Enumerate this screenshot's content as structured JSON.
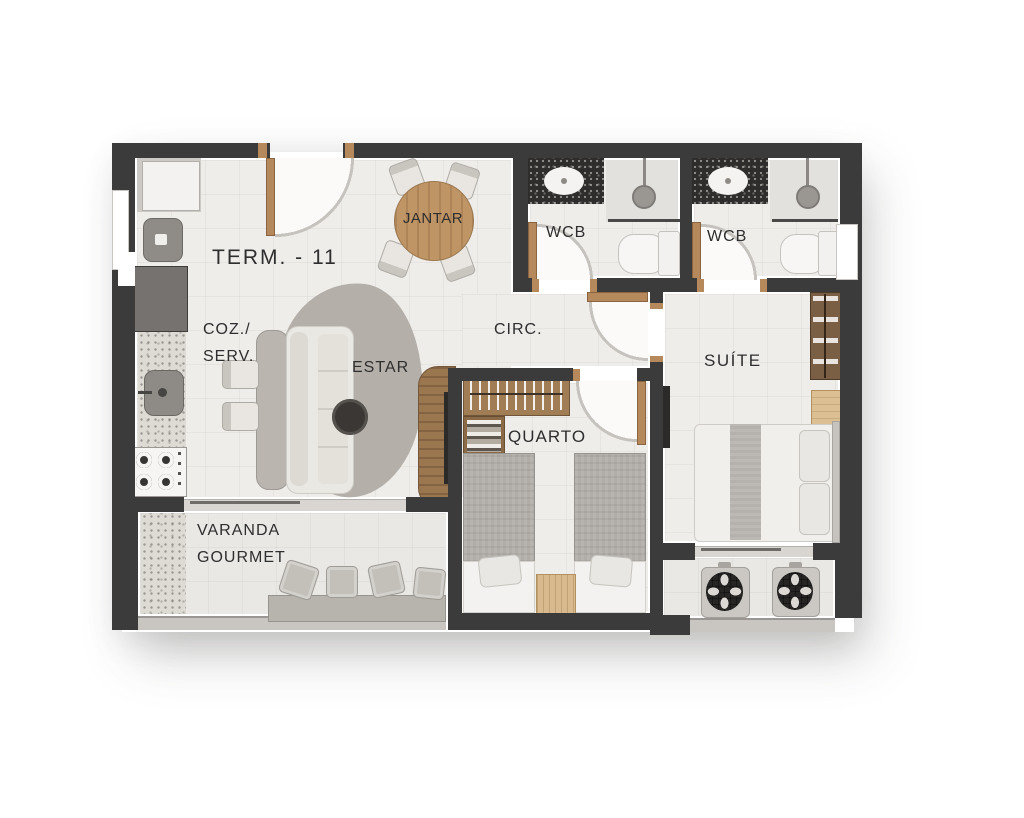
{
  "floorplan": {
    "title": "TERM. - 11",
    "labels": {
      "dining": "JANTAR",
      "bathroom_1": "WCB",
      "bathroom_2": "WCB",
      "circulation": "CIRC.",
      "kitchen_line1": "COZ./",
      "kitchen_line2": "SERV.",
      "living": "ESTAR",
      "bedroom": "QUARTO",
      "suite": "SUÍTE",
      "balcony_line1": "VARANDA",
      "balcony_line2": "GOURMET"
    },
    "colors": {
      "wall": "#3b3b3b",
      "floor": "#efedea",
      "door_wood": "#b5895c",
      "table_wood": "#c09565",
      "dark_wood": "#7a5f45",
      "label_text": "#2e2e2e"
    },
    "symbols": {
      "door_swing": "quarter-circle-arc",
      "sofa": "rounded-rect",
      "round_dining_table": "wood-circle",
      "coffee_table": "dark-circle",
      "toilet": "bowl-and-tank",
      "shower": "head-circle-with-stem",
      "sink": "oval-basin",
      "stove": "four-burners",
      "fridge": "white-box",
      "wardrobe": "hanging-clothes-top-view",
      "bed": "blanket-and-pillow",
      "ac_condenser": "fan-unit",
      "stool": "square-seat"
    }
  }
}
